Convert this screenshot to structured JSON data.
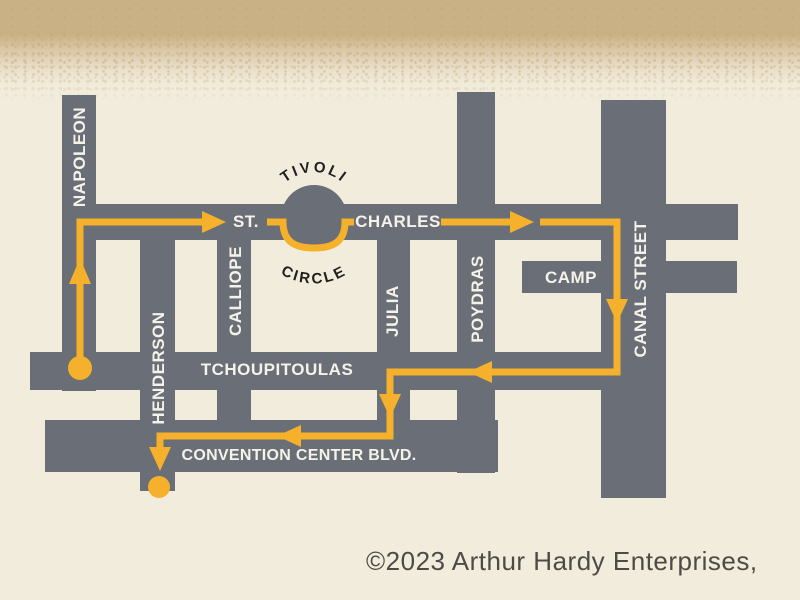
{
  "page": {
    "background_color": "#f2ecdc",
    "band_color": "#cab185"
  },
  "map": {
    "street_color": "#6a6e76",
    "route_color": "#f5b12b",
    "street_label_color": "#f4f2e9",
    "circle_label_color": "#1f1f1f",
    "streets": {
      "napoleon": "NAPOLEON",
      "henderson": "HENDERSON",
      "calliope": "CALLIOPE",
      "julia": "JULIA",
      "poydras": "POYDRAS",
      "canal": "CANAL STREET",
      "st": "ST.",
      "charles": "CHARLES",
      "camp": "CAMP",
      "tchoupitoulas": "TCHOUPITOULAS",
      "convention_center": "CONVENTION CENTER BLVD.",
      "tivoli": "TIVOLI",
      "circle": "CIRCLE"
    }
  },
  "copyright": "©2023 Arthur Hardy Enterprises,"
}
